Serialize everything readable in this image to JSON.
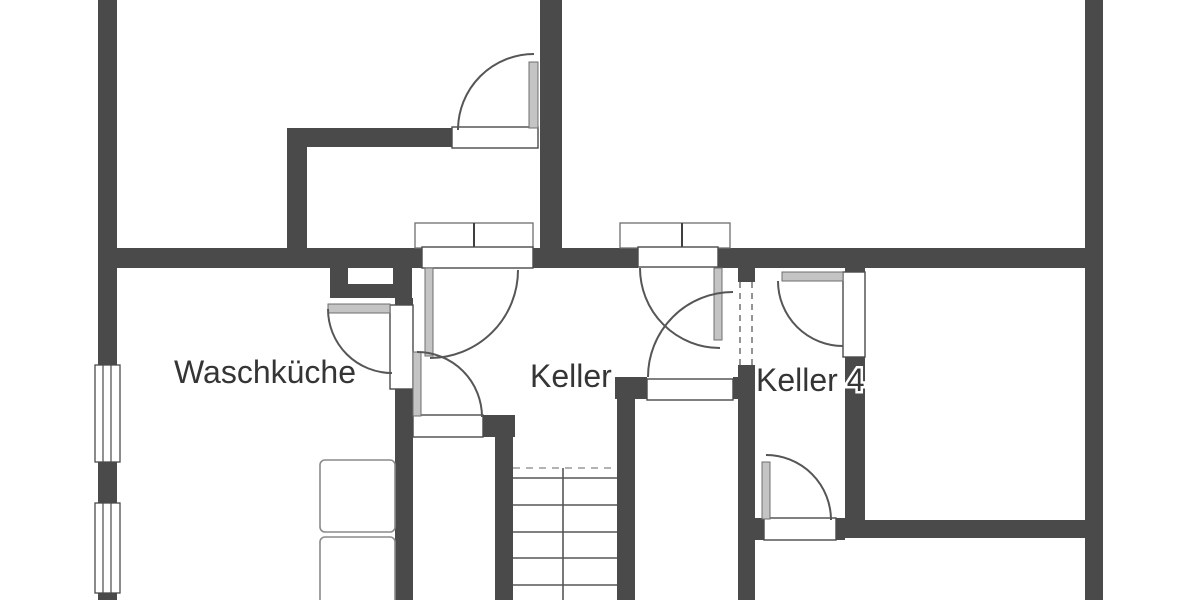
{
  "floor_plan": {
    "labels": {
      "laundry_room": "Waschküche",
      "cellar": "Keller",
      "cellar_4": "Keller 4"
    },
    "colors": {
      "wall": "#4a4a4a",
      "door_leaf": "#c4c4c4",
      "door_arc": "#565656",
      "background": "#ffffff",
      "text": "#353535"
    }
  }
}
